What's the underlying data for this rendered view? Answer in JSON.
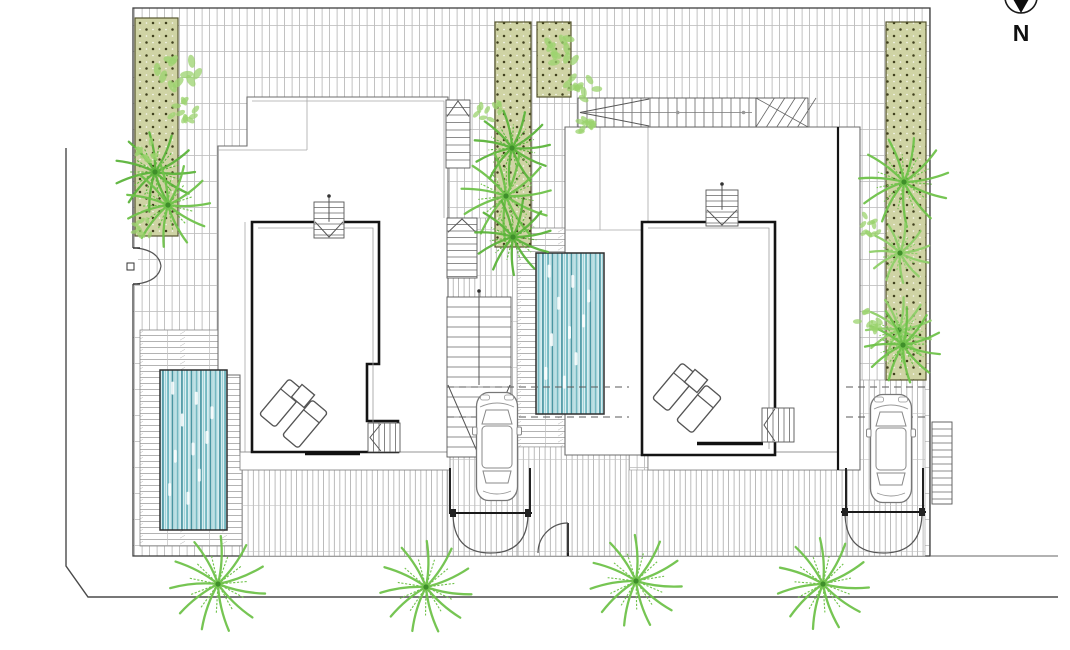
{
  "compass": {
    "label": "N"
  },
  "colors": {
    "palm_dark": "#5cb43b",
    "palm": "#6fc24a",
    "palm_light": "#8ecf68",
    "palm_center": "#3f8f2a",
    "bush": "#9bd36e",
    "planter_fill": "#cfd3a4",
    "planter_dot": "#3f3f1c",
    "pool_light": "#dceff1",
    "pool_stripe": "#4a96a2",
    "wall": "#141414",
    "line": "#555555",
    "tile_line": "#b3b3b3"
  },
  "site": {
    "x": 133,
    "y": 8,
    "w": 797,
    "h": 548
  },
  "street": {
    "vx": 66,
    "vy1": 148,
    "vy2": 566,
    "cx": 88,
    "cy": 597,
    "hx2": 1058,
    "ext_y": 556,
    "ext_x1": 930,
    "ext_x2": 1058
  },
  "planters": [
    {
      "x": 135,
      "y": 18,
      "w": 43,
      "h": 218
    },
    {
      "x": 495,
      "y": 22,
      "w": 36,
      "h": 225
    },
    {
      "x": 537,
      "y": 22,
      "w": 34,
      "h": 75
    },
    {
      "x": 886,
      "y": 22,
      "w": 40,
      "h": 358
    }
  ],
  "decks": [
    {
      "x": 140,
      "y": 330,
      "w": 102,
      "h": 216
    },
    {
      "x": 517,
      "y": 228,
      "w": 112,
      "h": 219
    }
  ],
  "drives": [
    {
      "x": 447,
      "y": 218,
      "w": 70,
      "h": 338
    },
    {
      "x": 846,
      "y": 380,
      "w": 79,
      "h": 176
    },
    {
      "x": 517,
      "y": 447,
      "w": 112,
      "h": 109
    },
    {
      "x": 629,
      "y": 470,
      "w": 217,
      "h": 86
    },
    {
      "x": 242,
      "y": 470,
      "w": 205,
      "h": 86
    }
  ],
  "pools": [
    {
      "x": 160,
      "y": 370,
      "w": 67,
      "h": 160
    },
    {
      "x": 536,
      "y": 253,
      "w": 68,
      "h": 161
    }
  ],
  "palms": [
    {
      "x": 155,
      "y": 172,
      "r": 40,
      "tone": 0
    },
    {
      "x": 168,
      "y": 205,
      "r": 42,
      "tone": 1
    },
    {
      "x": 512,
      "y": 148,
      "r": 38,
      "tone": 0
    },
    {
      "x": 506,
      "y": 196,
      "r": 45,
      "tone": 1
    },
    {
      "x": 513,
      "y": 237,
      "r": 38,
      "tone": 0
    },
    {
      "x": 904,
      "y": 182,
      "r": 45,
      "tone": 1
    },
    {
      "x": 900,
      "y": 253,
      "r": 30,
      "tone": 2
    },
    {
      "x": 899,
      "y": 330,
      "r": 33,
      "tone": 2
    },
    {
      "x": 903,
      "y": 345,
      "r": 38,
      "tone": 1
    },
    {
      "x": 218,
      "y": 584,
      "r": 48,
      "tone": 1
    },
    {
      "x": 426,
      "y": 587,
      "r": 46,
      "tone": 1
    },
    {
      "x": 636,
      "y": 581,
      "r": 46,
      "tone": 1
    },
    {
      "x": 823,
      "y": 584,
      "r": 46,
      "tone": 1
    }
  ],
  "bushes": [
    {
      "x": 178,
      "y": 75,
      "r": 22
    },
    {
      "x": 185,
      "y": 112,
      "r": 16
    },
    {
      "x": 150,
      "y": 150,
      "r": 14
    },
    {
      "x": 560,
      "y": 50,
      "r": 20
    },
    {
      "x": 585,
      "y": 85,
      "r": 18
    },
    {
      "x": 590,
      "y": 130,
      "r": 16
    },
    {
      "x": 488,
      "y": 110,
      "r": 14
    },
    {
      "x": 872,
      "y": 225,
      "r": 14
    },
    {
      "x": 870,
      "y": 320,
      "r": 15
    },
    {
      "x": 143,
      "y": 228,
      "r": 12
    }
  ],
  "cars": [
    {
      "x": 472,
      "y": 390
    },
    {
      "x": 866,
      "y": 392
    }
  ],
  "loungers": [
    {
      "x": 282,
      "y": 403,
      "rot": 40,
      "t": "l"
    },
    {
      "x": 305,
      "y": 424,
      "rot": 40,
      "t": "l"
    },
    {
      "x": 303,
      "y": 396,
      "rot": 40,
      "t": "t"
    },
    {
      "x": 675,
      "y": 387,
      "rot": 40,
      "t": "l"
    },
    {
      "x": 699,
      "y": 409,
      "rot": 40,
      "t": "l"
    },
    {
      "x": 696,
      "y": 381,
      "rot": 40,
      "t": "t"
    }
  ],
  "stairs": [
    {
      "x": 446,
      "y": 100,
      "w": 24,
      "h": 68,
      "o": "y",
      "st": 7.5,
      "arrow": "u"
    },
    {
      "x": 314,
      "y": 202,
      "w": 30,
      "h": 36,
      "o": "y",
      "st": 5.5,
      "arrow": "d",
      "stem": 1
    },
    {
      "x": 447,
      "y": 218,
      "w": 30,
      "h": 60,
      "o": "y",
      "st": 6.5,
      "arrow": "u"
    },
    {
      "x": 447,
      "y": 297,
      "w": 64,
      "h": 160,
      "o": "y",
      "st": 10,
      "arrow": "d",
      "stem": 1
    },
    {
      "x": 368,
      "y": 423,
      "w": 32,
      "h": 29,
      "o": "x",
      "st": 5.5,
      "arrow": "l"
    },
    {
      "x": 578,
      "y": 98,
      "w": 178,
      "h": 29,
      "o": "x",
      "st": 9,
      "arrow": "l",
      "mid": 1
    },
    {
      "x": 756,
      "y": 98,
      "w": 52,
      "h": 29,
      "o": "x",
      "st": 9,
      "diag": 1
    },
    {
      "x": 706,
      "y": 190,
      "w": 32,
      "h": 36,
      "o": "y",
      "st": 5.5,
      "arrow": "d",
      "stem": 1
    },
    {
      "x": 762,
      "y": 408,
      "w": 32,
      "h": 34,
      "o": "x",
      "st": 5.5,
      "arrow": "l"
    },
    {
      "x": 932,
      "y": 422,
      "w": 20,
      "h": 82,
      "o": "y",
      "st": 7
    }
  ],
  "gates": [
    {
      "type": "double",
      "x": 453,
      "y": 513,
      "w": 75,
      "h": 40
    },
    {
      "type": "single",
      "x": 540,
      "y": 523,
      "w": 28,
      "h": 30
    },
    {
      "type": "double",
      "x": 845,
      "y": 512,
      "w": 77,
      "h": 41
    },
    {
      "type": "side",
      "x": 133,
      "y": 248,
      "w": 28,
      "h": 36
    }
  ],
  "dashed": [
    {
      "x1": 447,
      "y": 387,
      "x2": 629
    },
    {
      "x1": 447,
      "y": 417,
      "x2": 629
    },
    {
      "x1": 846,
      "y": 387,
      "x2": 925
    },
    {
      "x1": 846,
      "y": 417,
      "x2": 925
    }
  ]
}
